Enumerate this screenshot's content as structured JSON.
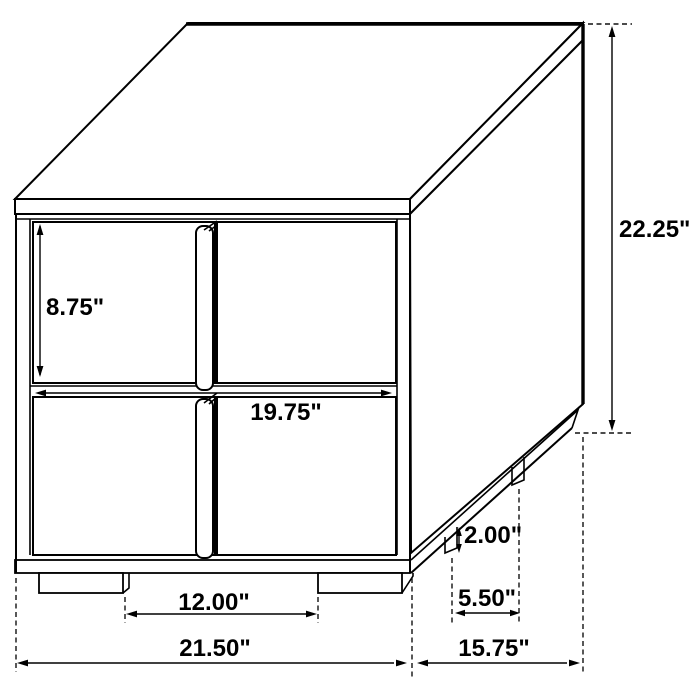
{
  "diagram": {
    "units": "inches",
    "colors": {
      "background": "#ffffff",
      "line": "#000000",
      "text": "#000000"
    },
    "measurements": {
      "drawer_opening_height": "8.75\"",
      "overall_height": "22.25\"",
      "drawer_width": "19.75\"",
      "front_leg_gap": "12.00\"",
      "overall_width": "21.50\"",
      "overall_depth": "15.75\"",
      "side_leg_spacing": "5.50\"",
      "leg_height": "2.00\""
    }
  }
}
